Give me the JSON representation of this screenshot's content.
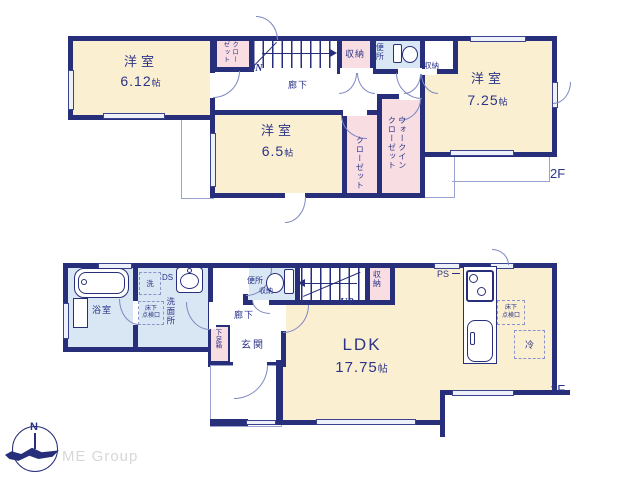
{
  "colors": {
    "wall": "#272f7b",
    "room": "#faefd0",
    "closet": "#f8dde2",
    "wet": "#d9e6f4",
    "thin": "#9aa3cf",
    "arc": "#7d87c0",
    "txt": "#2b3488",
    "logo": "#d7d7d7"
  },
  "floor2": {
    "floor_label": "2F",
    "rooms": {
      "bedroom1": {
        "name": "洋室",
        "size": "6.12",
        "unit": "帖"
      },
      "bedroom2": {
        "name": "洋室",
        "size": "6.5",
        "unit": "帖"
      },
      "bedroom3": {
        "name": "洋室",
        "size": "7.25",
        "unit": "帖"
      }
    },
    "closet_top": {
      "col_right": "クロー",
      "col_left": "ゼット"
    },
    "closet_mid": "クローゼット",
    "wic": {
      "col_right": "ウォークイン",
      "col_left": "クローゼット"
    },
    "storage_hall": "収納",
    "storage_room": "収納",
    "toilet": "便所",
    "hallway": "廊下",
    "stair_direction": "DN"
  },
  "floor1": {
    "floor_label": "1F",
    "ldk": {
      "name": "LDK",
      "size": "17.75",
      "unit": "帖"
    },
    "bathroom": "浴室",
    "washroom": "洗面所",
    "laundry": "洗",
    "duct": "DS",
    "inspection_wash": {
      "line1": "床下",
      "line2": "点検口"
    },
    "inspection_ldk": {
      "line1": "床下",
      "line2": "点検口"
    },
    "shoe_box": "下足箱",
    "hallway": "廊下",
    "entrance": "玄関",
    "toilet": "便所",
    "toilet_storage": "収納",
    "stair_storage": "収納",
    "stair_direction": "UP",
    "pipe_space": "PS",
    "refrigerator": "冷"
  },
  "logo": {
    "north": "N",
    "company": "ME Group"
  }
}
